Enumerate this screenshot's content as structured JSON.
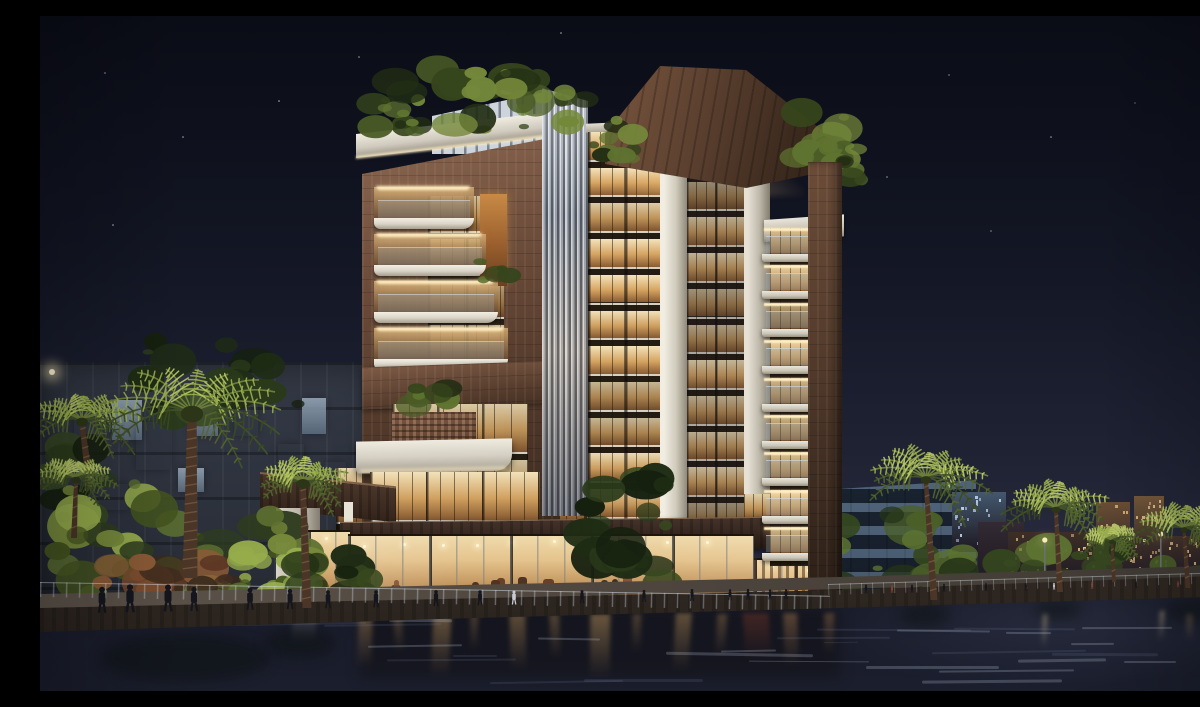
{
  "scene": {
    "description": "Night-time architectural rendering of a modern waterfront residential tower. A 12-storey building with warm illuminated glass facades, brown stone frames, stacked white balconies, vertical metal fins and a dark timber rooftop canopy stands behind a canal promenade lined with palm trees, shrubs and strolling people. Ground floor restaurants glow warmly; city buildings and lit towers sit in the right background; reflections shimmer in the dark water.",
    "time_of_day": "night",
    "setting": "canal promenade with palm trees and retail podium"
  },
  "palette": {
    "skyTop": "#0a0c16",
    "skyMid": "#131624",
    "skyLow": "#1f2334",
    "skyHorizon": "#333649",
    "stoneLight": "#8a6750",
    "stone": "#5f4433",
    "stoneDark": "#3b2a1f",
    "woodCanopy": "#63452f",
    "woodDark": "#2c1f16",
    "white": "#e7e3d8",
    "whiteShade": "#b2ada1",
    "soffitGlow": "#ffedc2",
    "glassHi": "#f8e6bc",
    "glassWarm": "#dcae6e",
    "glassLow": "#96683a",
    "slabDark": "#241c13",
    "finLight": "#dde2e8",
    "finMid": "#a7aeb8",
    "finDark": "#565d68",
    "foliageHi": "#a5bb5e",
    "foliage": "#6d8040",
    "foliageLow": "#36451f",
    "foliageDark": "#1b2410",
    "waterTop": "#171927",
    "waterDeep": "#11131e",
    "ripple": "#8f9cb8",
    "lampGlow": "#ffe9b0",
    "peopleDark": "#14151d",
    "peopleLight": "#c8cbd3"
  },
  "stars": [
    [
      64,
      56
    ],
    [
      142,
      120
    ],
    [
      238,
      84
    ],
    [
      318,
      40
    ],
    [
      520,
      16
    ],
    [
      908,
      58
    ],
    [
      1010,
      120
    ],
    [
      1094,
      86
    ],
    [
      1160,
      150
    ],
    [
      846,
      160
    ],
    [
      72,
      208
    ],
    [
      950,
      214
    ]
  ],
  "bg_windows": [
    {
      "x": 34,
      "y": 390,
      "w": 26,
      "h": 34,
      "c": "warm"
    },
    {
      "x": 72,
      "y": 384,
      "w": 30,
      "h": 40,
      "c": "cool"
    },
    {
      "x": 96,
      "y": 406,
      "w": 34,
      "h": 48,
      "c": "warm"
    },
    {
      "x": 150,
      "y": 380,
      "w": 28,
      "h": 40,
      "c": "cool"
    },
    {
      "x": 194,
      "y": 386,
      "w": 24,
      "h": 34,
      "c": "warm"
    },
    {
      "x": 238,
      "y": 428,
      "w": 26,
      "h": 30,
      "c": "warm"
    },
    {
      "x": 58,
      "y": 468,
      "w": 30,
      "h": 26,
      "c": "warm"
    },
    {
      "x": 138,
      "y": 452,
      "w": 26,
      "h": 24,
      "c": "cool"
    },
    {
      "x": 262,
      "y": 382,
      "w": 24,
      "h": 36,
      "c": "cool"
    },
    {
      "x": 284,
      "y": 446,
      "w": 22,
      "h": 26,
      "c": "warm"
    }
  ],
  "distant_blocks": [
    {
      "x": 912,
      "y": 476,
      "w": 54,
      "h": 60,
      "c": "#44586e",
      "lit": "cool"
    },
    {
      "x": 938,
      "y": 506,
      "w": 46,
      "h": 62,
      "c": "#332a33",
      "lit": "none"
    },
    {
      "x": 968,
      "y": 516,
      "w": 88,
      "h": 52,
      "c": "#3d2f27",
      "lit": "warm"
    },
    {
      "x": 1056,
      "y": 486,
      "w": 34,
      "h": 80,
      "c": "#6b4f35",
      "lit": "warm"
    },
    {
      "x": 1094,
      "y": 480,
      "w": 30,
      "h": 86,
      "c": "#74583a",
      "lit": "warm"
    },
    {
      "x": 1080,
      "y": 520,
      "w": 96,
      "h": 48,
      "c": "#46352c",
      "lit": "warm"
    },
    {
      "x": 1170,
      "y": 512,
      "w": 30,
      "h": 56,
      "c": "#3a2d3a",
      "lit": "none"
    }
  ],
  "palms": [
    {
      "cx": 42,
      "cy": 404,
      "r": 58,
      "bx": 50,
      "by": 470,
      "tw": 8
    },
    {
      "cx": 36,
      "cy": 462,
      "r": 40,
      "bx": 34,
      "by": 522,
      "tw": 6
    },
    {
      "cx": 152,
      "cy": 396,
      "r": 92,
      "bx": 150,
      "by": 562,
      "tw": 15
    },
    {
      "cx": 263,
      "cy": 466,
      "r": 48,
      "bx": 267,
      "by": 592,
      "tw": 9
    },
    {
      "cx": 886,
      "cy": 462,
      "r": 62,
      "bx": 894,
      "by": 584,
      "tw": 7
    },
    {
      "cx": 1016,
      "cy": 492,
      "r": 55,
      "bx": 1020,
      "by": 576,
      "tw": 6
    },
    {
      "cx": 1072,
      "cy": 524,
      "r": 30,
      "bx": 1074,
      "by": 566,
      "tw": 4
    },
    {
      "cx": 1144,
      "cy": 512,
      "r": 48,
      "bx": 1148,
      "by": 572,
      "tw": 5
    }
  ],
  "bushes": [
    {
      "x": 0,
      "y": 430,
      "w": 70,
      "h": 90,
      "n": 16,
      "p": "bushDark"
    },
    {
      "x": 14,
      "y": 468,
      "w": 136,
      "h": 112,
      "n": 26,
      "p": "bush"
    },
    {
      "x": 148,
      "y": 498,
      "w": 95,
      "h": 84,
      "n": 18,
      "p": "bush"
    },
    {
      "x": 52,
      "y": 546,
      "w": 140,
      "h": 34,
      "n": 16,
      "p": "flower"
    },
    {
      "x": 198,
      "y": 518,
      "w": 74,
      "h": 62,
      "n": 14,
      "p": "bush"
    },
    {
      "x": 240,
      "y": 540,
      "w": 90,
      "h": 48,
      "n": 12,
      "p": "bushDark"
    }
  ],
  "veg_back": [
    {
      "x": 95,
      "y": 322,
      "w": 175,
      "h": 82,
      "n": 22,
      "p": "bushDark"
    },
    {
      "x": 775,
      "y": 497,
      "w": 115,
      "h": 85,
      "n": 22,
      "p": "bushMid"
    },
    {
      "x": 888,
      "y": 532,
      "w": 308,
      "h": 46,
      "n": 34,
      "p": "bushMid"
    }
  ],
  "store_tree": {
    "x": 543,
    "y": 460,
    "w": 84,
    "h": 108,
    "n": 20,
    "p": "bushDark"
  },
  "roof_greens": [
    {
      "x": 330,
      "y": 84,
      "w": 52,
      "h": 34,
      "n": 10
    },
    {
      "x": 350,
      "y": 50,
      "w": 128,
      "h": 64,
      "n": 20
    },
    {
      "x": 468,
      "y": 62,
      "w": 78,
      "h": 54,
      "n": 14
    },
    {
      "x": 546,
      "y": 104,
      "w": 52,
      "h": 44,
      "n": 10
    },
    {
      "x": 746,
      "y": 92,
      "w": 64,
      "h": 58,
      "n": 14
    },
    {
      "x": 778,
      "y": 128,
      "w": 46,
      "h": 38,
      "n": 9
    },
    {
      "x": 356,
      "y": 364,
      "w": 54,
      "h": 26,
      "n": 8
    },
    {
      "x": 438,
      "y": 244,
      "w": 32,
      "h": 20,
      "n": 6
    }
  ],
  "lamps": [
    {
      "x": 12,
      "y": 356,
      "r": 3,
      "type": "dot"
    },
    {
      "x": 1004,
      "y": 524,
      "h": 42,
      "type": "pole"
    },
    {
      "x": 1120,
      "y": 518,
      "h": 42,
      "type": "pole"
    }
  ],
  "reflection_streaks": [
    {
      "x": 252,
      "w": 24,
      "h": 30,
      "c": "rgba(205,205,195,.22)"
    },
    {
      "x": 318,
      "w": 14,
      "h": 52,
      "c": "rgba(224,170,100,.35)"
    },
    {
      "x": 354,
      "w": 9,
      "h": 40,
      "c": "rgba(224,170,100,.28)"
    },
    {
      "x": 392,
      "w": 18,
      "h": 60,
      "c": "rgba(230,178,104,.38)"
    },
    {
      "x": 430,
      "w": 8,
      "h": 36,
      "c": "rgba(224,170,100,.25)"
    },
    {
      "x": 470,
      "w": 16,
      "h": 56,
      "c": "rgba(230,178,104,.34)"
    },
    {
      "x": 510,
      "w": 10,
      "h": 44,
      "c": "rgba(224,170,100,.3)"
    },
    {
      "x": 550,
      "w": 20,
      "h": 64,
      "c": "rgba(233,182,108,.4)"
    },
    {
      "x": 592,
      "w": 9,
      "h": 38,
      "c": "rgba(224,170,100,.26)"
    },
    {
      "x": 634,
      "w": 16,
      "h": 58,
      "c": "rgba(230,178,104,.36)"
    },
    {
      "x": 676,
      "w": 10,
      "h": 42,
      "c": "rgba(224,170,100,.28)"
    },
    {
      "x": 704,
      "w": 26,
      "h": 46,
      "c": "rgba(160,70,45,.32)"
    },
    {
      "x": 744,
      "w": 14,
      "h": 52,
      "c": "rgba(224,160,95,.33)"
    },
    {
      "x": 784,
      "w": 10,
      "h": 40,
      "c": "rgba(210,150,90,.3)"
    },
    {
      "x": 1002,
      "w": 5,
      "h": 34,
      "c": "rgba(255,230,170,.4)"
    },
    {
      "x": 1119,
      "w": 5,
      "h": 30,
      "c": "rgba(255,230,170,.38)"
    },
    {
      "x": 1146,
      "w": 7,
      "h": 26,
      "c": "rgba(235,190,120,.3)"
    }
  ],
  "people_left": [
    [
      62,
      26
    ],
    [
      90,
      28
    ],
    [
      128,
      27
    ],
    [
      154,
      24
    ],
    [
      210,
      22
    ],
    [
      250,
      20
    ],
    [
      288,
      18
    ],
    [
      336,
      17
    ],
    [
      396,
      16
    ],
    [
      440,
      15
    ],
    [
      474,
      14
    ],
    [
      542,
      13
    ],
    [
      604,
      12
    ],
    [
      652,
      12
    ],
    [
      690,
      11
    ],
    [
      708,
      11
    ],
    [
      730,
      10
    ],
    [
      746,
      10
    ]
  ],
  "people_right": [
    [
      826,
      9
    ],
    [
      852,
      8
    ],
    [
      872,
      8
    ],
    [
      904,
      8
    ],
    [
      946,
      8
    ],
    [
      986,
      7
    ],
    [
      1014,
      7
    ],
    [
      1052,
      7
    ],
    [
      1096,
      7
    ],
    [
      1138,
      6
    ]
  ],
  "counts": {
    "tower_floors": 11,
    "right_balconies": 9,
    "left_cascade_balconies": 4,
    "storefront_bays": 6
  }
}
